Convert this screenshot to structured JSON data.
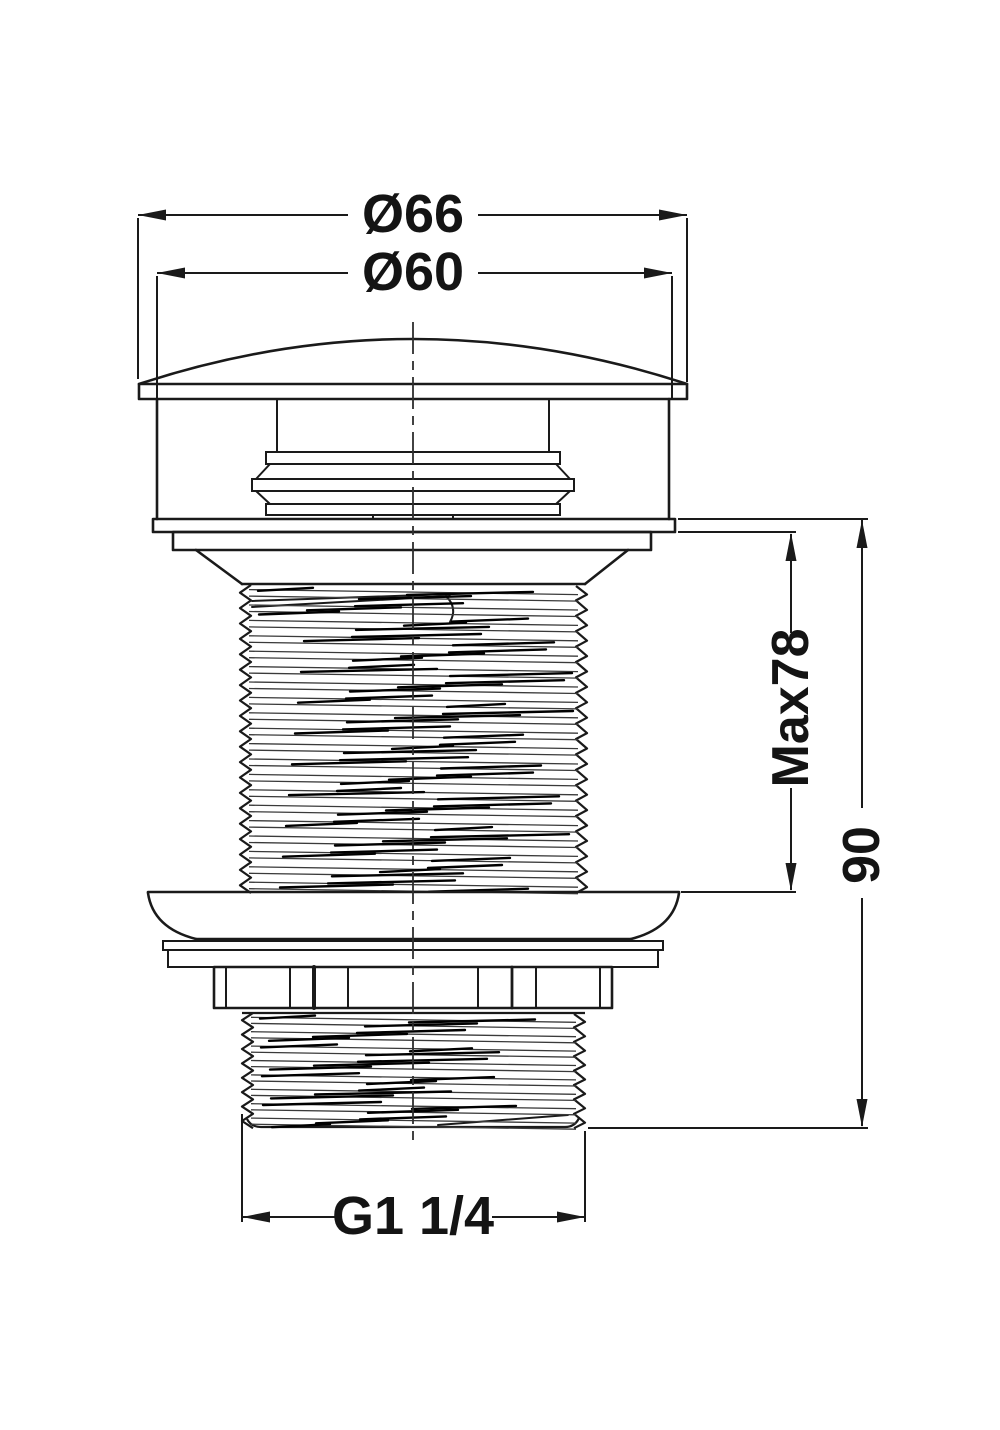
{
  "drawing": {
    "background": "#ffffff",
    "ink": "#1a1a1a",
    "labels": {
      "dia_outer": "Ø66",
      "dia_inner": "Ø60",
      "max_depth": "Max78",
      "overall_length": "90",
      "thread_spec": "G1 1/4"
    }
  }
}
